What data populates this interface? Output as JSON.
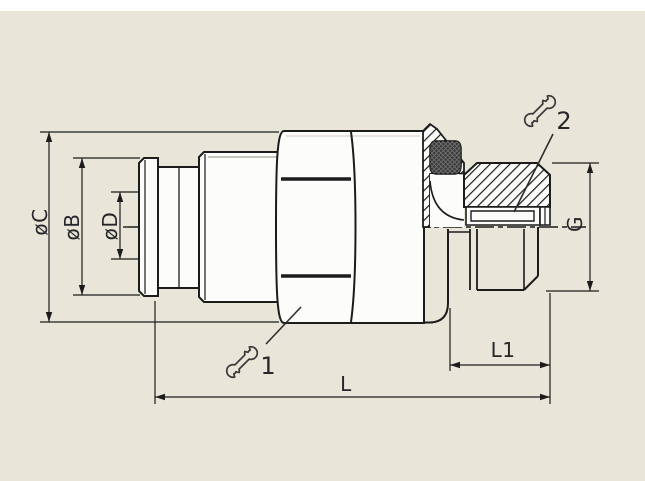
{
  "drawing": {
    "type": "technical-drawing",
    "subject": "push-in pneumatic fitting with male thread, side view with partial section",
    "colors": {
      "background": "#e9e6d9",
      "paper_strip": "#ffffff",
      "line": "#1c1c1c",
      "body_fill": "#fcfcfa",
      "oring": "#3a3a3a",
      "label": "#26262b"
    },
    "labels": {
      "dia_c": "øC",
      "dia_b": "øB",
      "dia_d": "øD",
      "thread": "G",
      "length_total": "L",
      "length_thread": "L1"
    },
    "callouts": {
      "wrench_1": "1",
      "wrench_2": "2"
    }
  }
}
